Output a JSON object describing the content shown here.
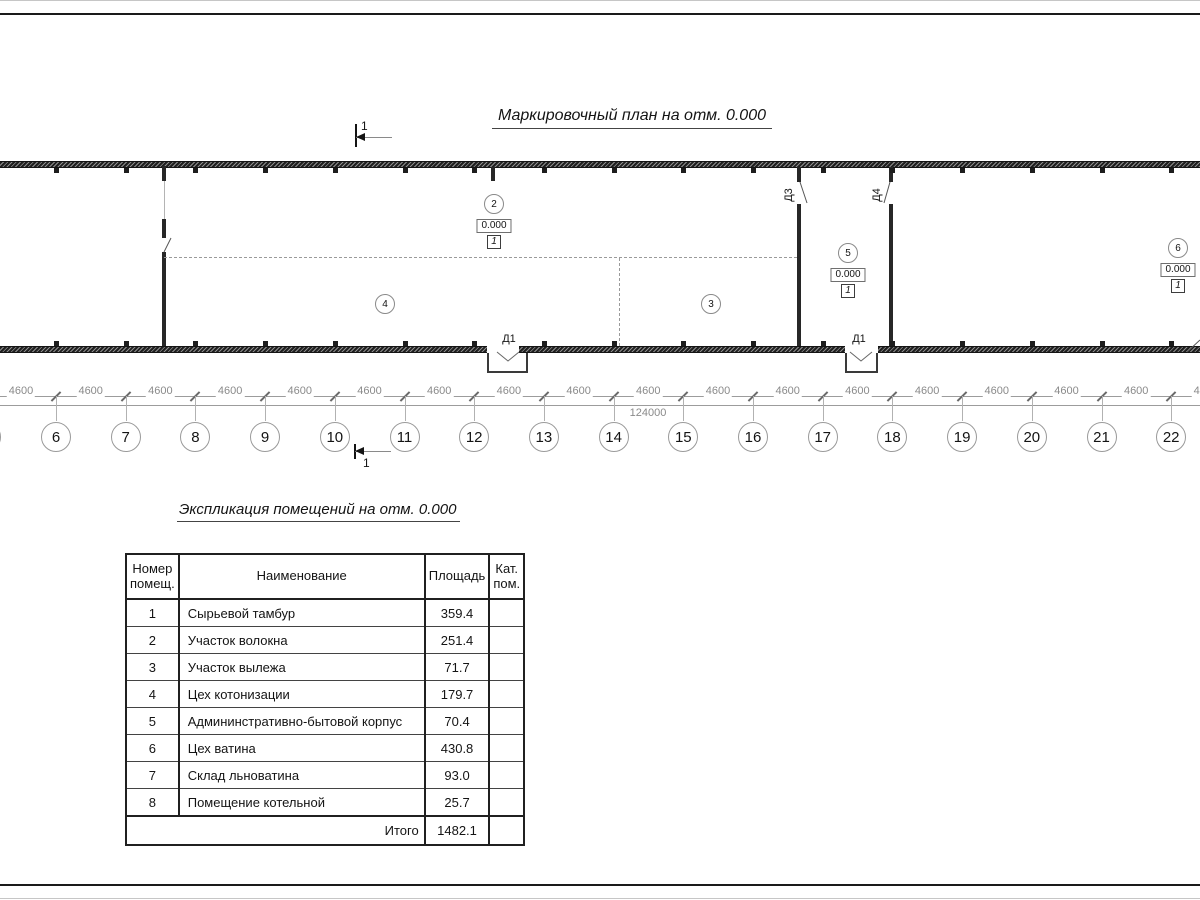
{
  "sheet": {
    "plan_title": "Маркировочный план на отм. 0.000",
    "table_title": "Экспликация помещений на отм. 0.000"
  },
  "plan": {
    "section_mark": "1",
    "rooms": [
      {
        "num": "2",
        "elevation": "0.000",
        "floor_type": "1"
      },
      {
        "num": "3"
      },
      {
        "num": "4"
      },
      {
        "num": "5",
        "elevation": "0.000",
        "floor_type": "1"
      },
      {
        "num": "6",
        "elevation": "0.000",
        "floor_type": "1"
      }
    ],
    "doors": [
      {
        "label": "Д1"
      },
      {
        "label": "Д1"
      },
      {
        "label": "Д3"
      },
      {
        "label": "Д4"
      }
    ],
    "dimensions": {
      "bay": "4600",
      "bay_count": 18,
      "overall": "124000"
    },
    "axes": [
      "6",
      "7",
      "8",
      "9",
      "10",
      "11",
      "12",
      "13",
      "14",
      "15",
      "16",
      "17",
      "18",
      "19",
      "20",
      "21",
      "22"
    ]
  },
  "table": {
    "headers": {
      "num": "Номер помещ.",
      "name": "Наименование",
      "area": "Площадь",
      "cat": "Кат. пом."
    },
    "rows": [
      {
        "num": "1",
        "name": "Сырьевой тамбур",
        "area": "359.4",
        "cat": ""
      },
      {
        "num": "2",
        "name": "Участок волокна",
        "area": "251.4",
        "cat": ""
      },
      {
        "num": "3",
        "name": "Участок вылежа",
        "area": "71.7",
        "cat": ""
      },
      {
        "num": "4",
        "name": "Цех котонизации",
        "area": "179.7",
        "cat": ""
      },
      {
        "num": "5",
        "name": "Админинстративно-бытовой корпус",
        "area": "70.4",
        "cat": ""
      },
      {
        "num": "6",
        "name": "Цех ватина",
        "area": "430.8",
        "cat": ""
      },
      {
        "num": "7",
        "name": "Склад льноватина",
        "area": "93.0",
        "cat": ""
      },
      {
        "num": "8",
        "name": "Помещение котельной",
        "area": "25.7",
        "cat": ""
      }
    ],
    "total": {
      "label": "Итого",
      "area": "1482.1",
      "cat": ""
    }
  }
}
